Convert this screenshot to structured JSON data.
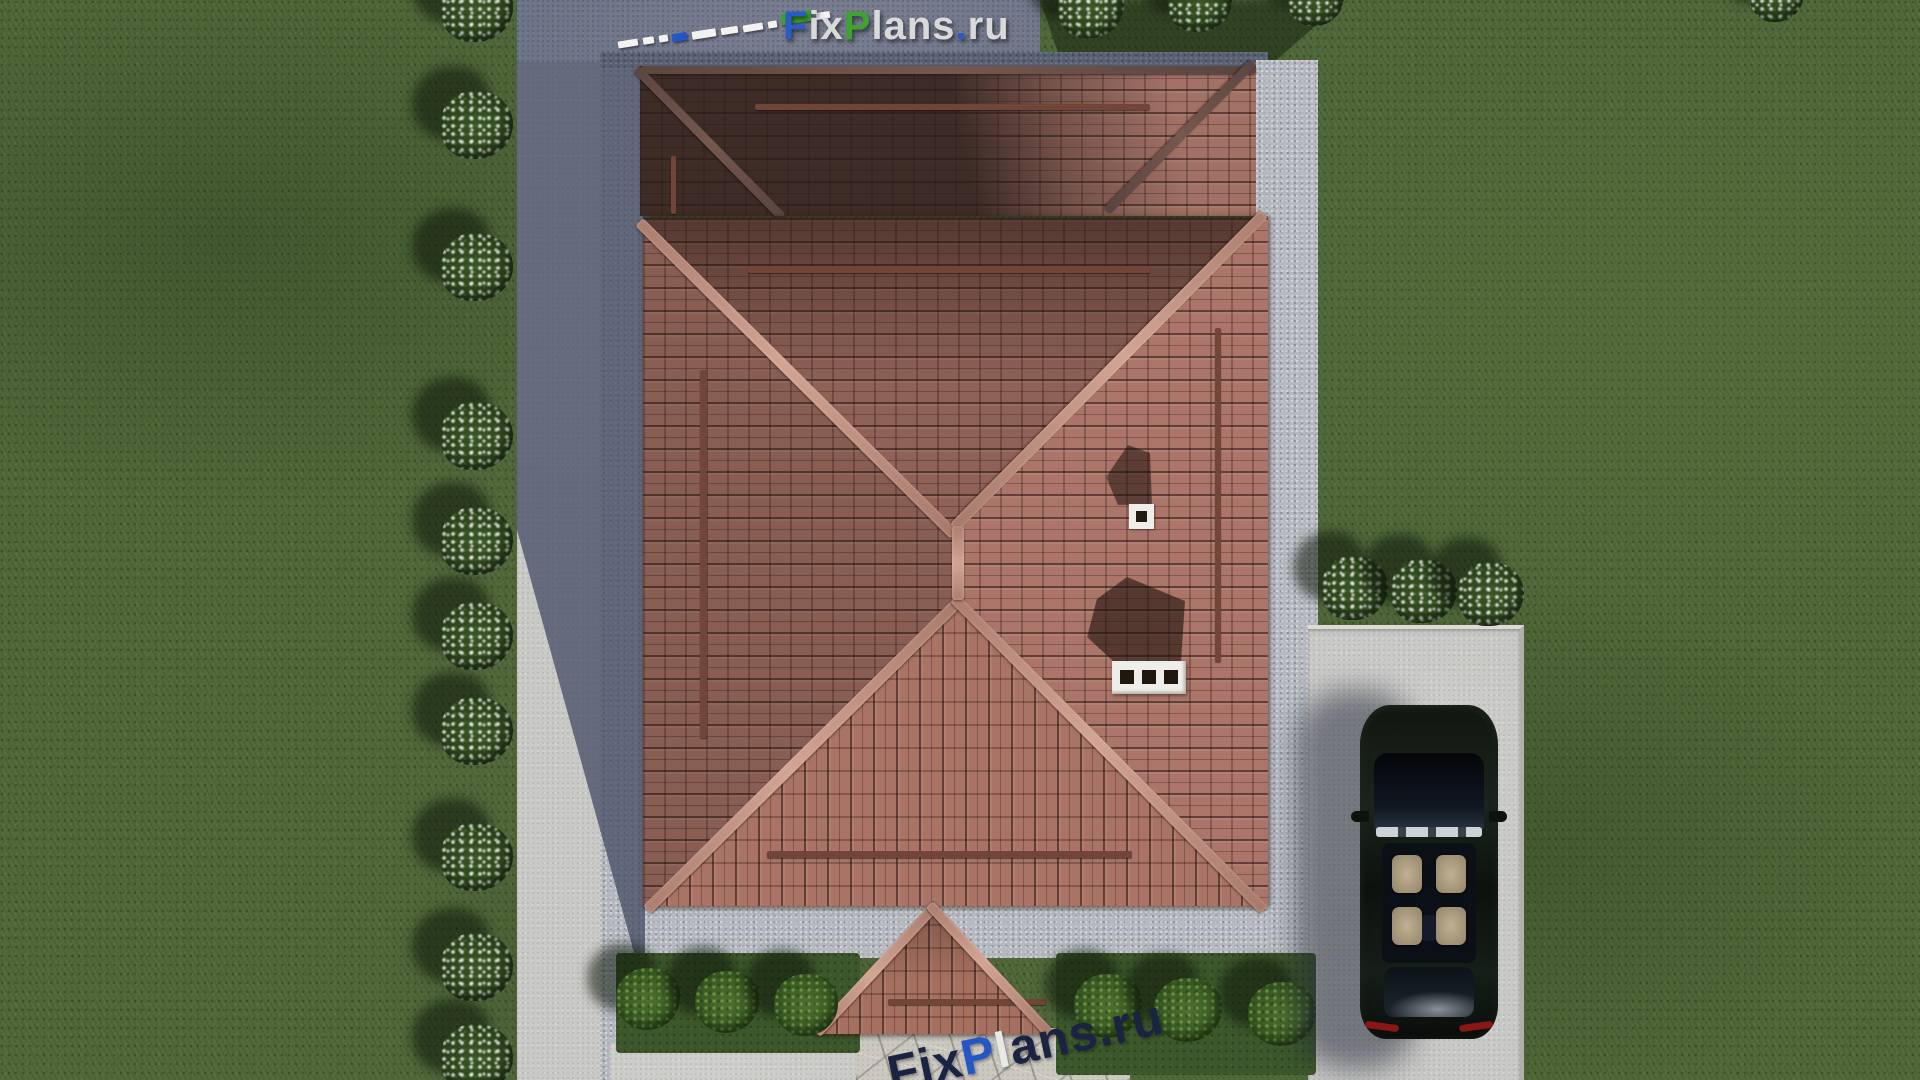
{
  "watermark_top": {
    "text": "FixPlans.ru",
    "segments": [
      {
        "text": "F",
        "color": "#2b5bc9"
      },
      {
        "text": "ix",
        "color": "#d9d9d9"
      },
      {
        "text": "P",
        "color": "#3fa42f"
      },
      {
        "text": "lans",
        "color": "#d9d9d9"
      },
      {
        "text": ".",
        "color": "#2b5bc9"
      },
      {
        "text": "ru",
        "color": "#d9d9d9"
      }
    ],
    "ruler_dash_colors": {
      "default": "#f2f2f0",
      "accent_blue": "#2456c6",
      "accent_green": "#3ca32f"
    }
  },
  "watermark_bottom": {
    "text": "FixPlans.ru",
    "segments": [
      {
        "text": "Fix",
        "color": "#1a2342"
      },
      {
        "text": "P",
        "color": "#2456c6"
      },
      {
        "text": "l",
        "color": "#e8e8e6"
      },
      {
        "text": "ans.ru",
        "color": "#1a2342"
      }
    ]
  },
  "scene": {
    "description": "Aerial top-down 3D render of a house with hipped terracotta tile roof, driveway, parked car and landscaped garden",
    "house": {
      "roof_tile_color": "#a97668",
      "ridge_color": "#c7998b",
      "chimney_color": "#efeeea",
      "chimney_vent_count": 3,
      "roof_vent_count": 1,
      "porch": "gabled tiled canopy at bottom center"
    },
    "car": {
      "body_color": "#10160f",
      "seat_color": "#b2a287",
      "position": "right concrete parking pad"
    },
    "landscape": {
      "grass_color": "#50683a",
      "concrete_color": "#c9c9c6",
      "gravel_color": "#b6bac0",
      "shadow_color": "#6f7588",
      "flower_bush_count_left": 10,
      "flower_bush_count_top": 4,
      "flower_bush_count_right": 3,
      "green_bush_count": 6
    }
  }
}
